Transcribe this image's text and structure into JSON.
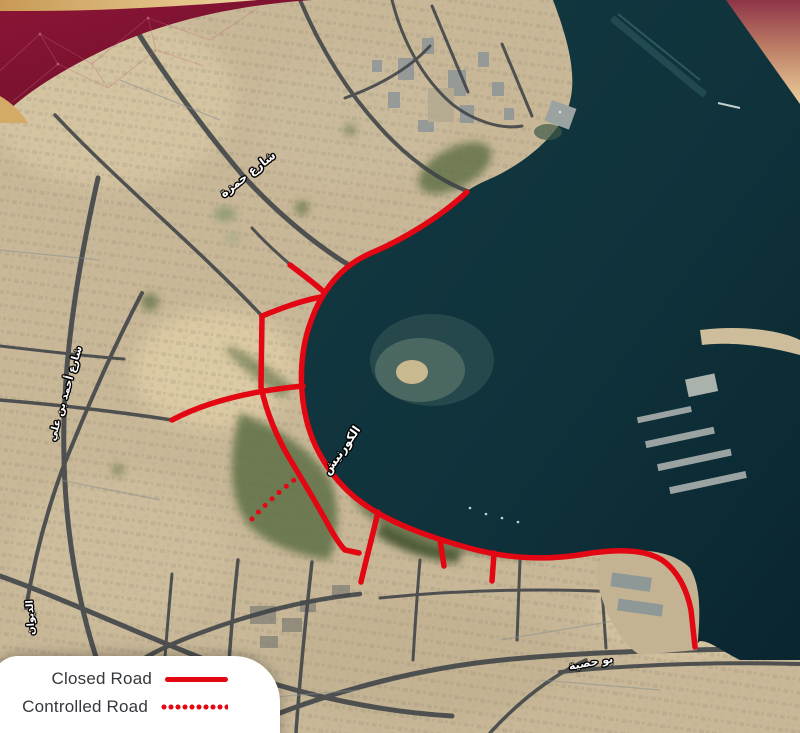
{
  "legend": {
    "items": [
      {
        "id": "closed-road",
        "label": "Closed Road",
        "line_style": "solid"
      },
      {
        "id": "controlled-road",
        "label": "Controlled Road",
        "line_style": "dotted"
      }
    ]
  },
  "map": {
    "type": "satellite-overlay-map",
    "road_labels": [
      {
        "id": "hamza-street",
        "text": "شارع حمزة"
      },
      {
        "id": "ahmed-bin-ali-street",
        "text": "شارع أحمد بن علي"
      },
      {
        "id": "corniche",
        "text": "الكورنيش"
      },
      {
        "id": "al-diwan-street",
        "text": "الديوان"
      },
      {
        "id": "bu-hasya-street",
        "text": "بو حصية"
      }
    ]
  },
  "colors": {
    "closed_road_red": "#E30613",
    "corner_maroon": "#7C1433",
    "corner_gold": "#E9C98F",
    "sea": "#10333C",
    "land": "#C9B898"
  }
}
